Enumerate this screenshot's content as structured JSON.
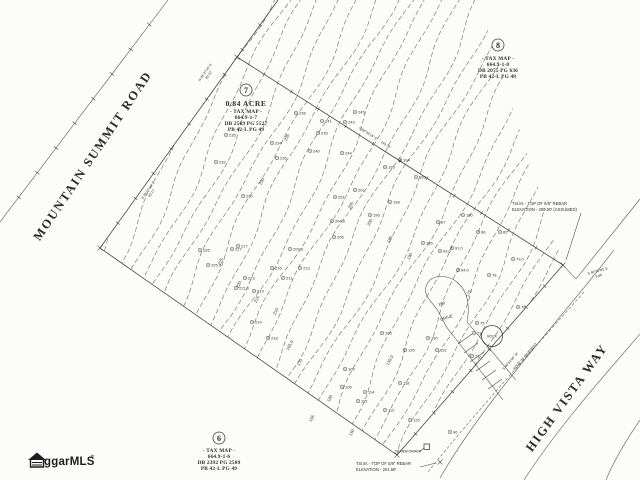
{
  "roads": {
    "mountain_summit": "MOUNTAIN SUMMIT ROAD",
    "high_vista": "HIGH VISTA WAY"
  },
  "parcels": {
    "lot7": {
      "number": "7",
      "acreage": "0.84 ACRE",
      "heading": "- TAX MAP -",
      "tax_id": "664.9-1-7",
      "deed": "DB 2569 PG 5527",
      "plat": "PB 42-L PG 49"
    },
    "lot8": {
      "number": "8",
      "heading": "- TAX MAP -",
      "tax_id": "664.9-1-8",
      "deed": "DB 2075 PG 636",
      "plat": "PB 42-L PG 49"
    },
    "lot6": {
      "number": "6",
      "heading": "- TAX MAP -",
      "tax_id": "664.9-1-6",
      "deed": "DB 2392 PG 2509",
      "plat": "PB 42-L PG 49"
    }
  },
  "benchmarks": {
    "upper": {
      "line1": "T.B.M. - TOP OF 5/8\" REBAR",
      "line2": "ELEVATION - 200.00' (ASSUMED)"
    },
    "lower": {
      "line1": "T.B.M. - TOP OF 5/8\" REBAR",
      "line2": "ELEVATION - 201.58'"
    }
  },
  "bearings": {
    "west_upper": {
      "bearing": "N 39°37'15\" E",
      "distance": "93.10'"
    },
    "west_lower": {
      "bearing": "N 39°37'15\" E",
      "distance": "92.17'"
    },
    "northeast": {
      "bearing": "S 50°36'15\" E",
      "distance": "244.70'"
    },
    "east_tie": {
      "bearing": "S 40°20'00\" E",
      "distance": "9.86'"
    },
    "southeast": {
      "bearing": "S 49°52'45\" W"
    }
  },
  "site_labels": {
    "drive": "DRIVE",
    "drive_contour": "180",
    "rock": "ROCK",
    "transformer": "TRANSFORMER",
    "edge_of_pavement": "EDGE OF PAVEMENT"
  },
  "logo": {
    "text": "ggarMLS",
    "trademark": "™"
  },
  "spot_elevations": [
    [
      296,
      113,
      "238"
    ],
    [
      322,
      121,
      "241"
    ],
    [
      318,
      133,
      "239"
    ],
    [
      272,
      143,
      "234"
    ],
    [
      310,
      151,
      "240"
    ],
    [
      277,
      158,
      "236"
    ],
    [
      226,
      135,
      "235"
    ],
    [
      216,
      162,
      "232"
    ],
    [
      243,
      196,
      "230"
    ],
    [
      355,
      112,
      "245"
    ],
    [
      345,
      122,
      "243"
    ],
    [
      342,
      153,
      "244"
    ],
    [
      335,
      197,
      "251"
    ],
    [
      400,
      160,
      "194"
    ],
    [
      385,
      167,
      "195"
    ],
    [
      416,
      177,
      "193"
    ],
    [
      390,
      202,
      "198"
    ],
    [
      370,
      215,
      "196"
    ],
    [
      355,
      190,
      "201"
    ],
    [
      332,
      221,
      "204.0"
    ],
    [
      334,
      237,
      "206"
    ],
    [
      290,
      249,
      "209.0"
    ],
    [
      238,
      246,
      "217"
    ],
    [
      200,
      250,
      "226"
    ],
    [
      232,
      249,
      "227"
    ],
    [
      208,
      265,
      "225.0"
    ],
    [
      245,
      278,
      "223"
    ],
    [
      236,
      288,
      "221.0"
    ],
    [
      254,
      291,
      "219"
    ],
    [
      272,
      268,
      "216"
    ],
    [
      283,
      278,
      "211"
    ],
    [
      300,
      268,
      "213"
    ],
    [
      252,
      322,
      "214"
    ],
    [
      268,
      338,
      "218"
    ],
    [
      463,
      215,
      "180"
    ],
    [
      423,
      243,
      "185"
    ],
    [
      438,
      222,
      "87"
    ],
    [
      440,
      251,
      "93.0"
    ],
    [
      452,
      248,
      "91.0"
    ],
    [
      478,
      232,
      "88"
    ],
    [
      458,
      270,
      "94.0"
    ],
    [
      513,
      259,
      "79.0"
    ],
    [
      500,
      232,
      "82"
    ],
    [
      489,
      275,
      "78"
    ],
    [
      518,
      307,
      "76"
    ],
    [
      477,
      323,
      "75"
    ],
    [
      474,
      333,
      "73"
    ],
    [
      472,
      356,
      "71"
    ],
    [
      428,
      338,
      "150"
    ],
    [
      437,
      350,
      "152"
    ],
    [
      382,
      333,
      "105"
    ],
    [
      405,
      350,
      "135"
    ],
    [
      345,
      369,
      "109"
    ],
    [
      342,
      387,
      "106"
    ],
    [
      365,
      392,
      "114"
    ],
    [
      358,
      401,
      "115"
    ],
    [
      400,
      383,
      "118"
    ],
    [
      410,
      420,
      "125"
    ],
    [
      385,
      410,
      "112"
    ],
    [
      450,
      432,
      "96"
    ]
  ],
  "contour_labels": [
    [
      288,
      138,
      "235"
    ],
    [
      263,
      182,
      "230"
    ],
    [
      222,
      262,
      "225"
    ],
    [
      240,
      285,
      "220"
    ],
    [
      258,
      300,
      "215"
    ],
    [
      277,
      312,
      "210"
    ],
    [
      352,
      206,
      "205"
    ],
    [
      371,
      223,
      "200"
    ],
    [
      391,
      240,
      "195"
    ],
    [
      411,
      257,
      "190"
    ],
    [
      291,
      346,
      "165.0"
    ],
    [
      301,
      363,
      "170"
    ],
    [
      331,
      399,
      "160"
    ],
    [
      313,
      419,
      "155"
    ],
    [
      353,
      433,
      "150"
    ],
    [
      391,
      361,
      "135.0"
    ],
    [
      470,
      294,
      "175"
    ]
  ]
}
